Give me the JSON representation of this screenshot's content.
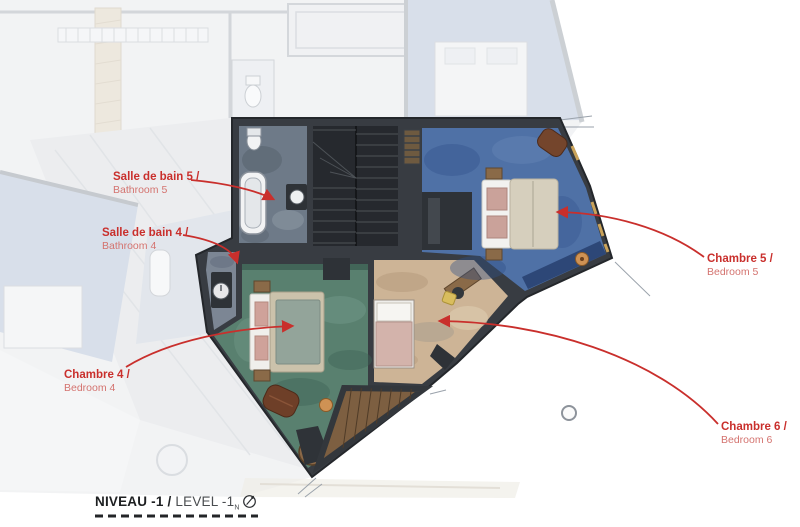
{
  "annotations": {
    "bathroom5": {
      "title": "Salle de bain 5 /",
      "subtitle": "Bathroom 5"
    },
    "bathroom4": {
      "title": "Salle de bain 4 /",
      "subtitle": "Bathroom 4"
    },
    "bedroom4": {
      "title": "Chambre 4 /",
      "subtitle": "Bedroom 4"
    },
    "bedroom5": {
      "title": "Chambre 5 /",
      "subtitle": "Bedroom 5"
    },
    "bedroom6": {
      "title": "Chambre 6 /",
      "subtitle": "Bedroom 6"
    }
  },
  "footer": {
    "title_fr": "NIVEAU -1 /",
    "title_en": " LEVEL -1",
    "north_mark": "N"
  },
  "colors": {
    "annotation_red": "#c92f2c",
    "annotation_red_light": "#d4736f",
    "wall_dark": "#383c42",
    "staircase_dark": "#26292e",
    "bedroom5_floor_blue": "#4f71a6",
    "bedroom4_floor_green": "#59806f",
    "bedroom6_floor_beige": "#cdb496",
    "bathroom_floor_slate": "#6e7a88",
    "wood_deck": "#7d5f41",
    "footer_text": "#1d1f21"
  }
}
